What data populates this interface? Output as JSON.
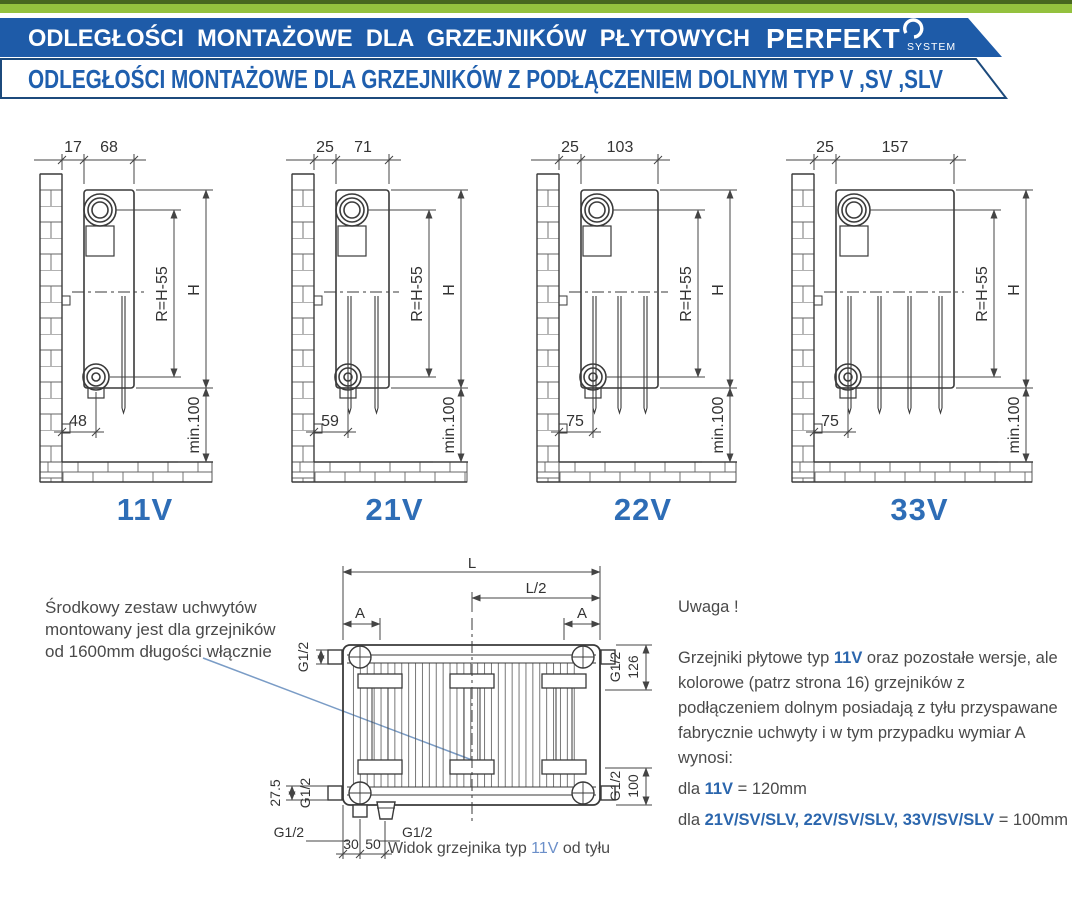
{
  "header": {
    "title": "ODLEGŁOŚCI MONTAŻOWE DLA GRZEJNIKÓW PŁYTOWYCH",
    "brand": "PERFEKT",
    "brand_sub": "SYSTEM",
    "subtitle": "ODLEGŁOŚCI MONTAŻOWE DLA GRZEJNIKÓW Z PODŁĄCZENIEM DOLNYM TYP V ,SV ,SLV",
    "colors": {
      "banner_blue": "#1e5ba8",
      "green_light": "#95c13e",
      "green_dark": "#4e6e28",
      "outline_navy": "#1c4a7c",
      "accent_blue": "#2e6db6"
    }
  },
  "diagrams": [
    {
      "label": "11V",
      "wall_offset": "17",
      "depth": "68",
      "bottom_offset": "48",
      "r_dim": "R=H-55",
      "h_dim": "H",
      "min_dim": "min.100"
    },
    {
      "label": "21V",
      "wall_offset": "25",
      "depth": "71",
      "bottom_offset": "59",
      "r_dim": "R=H-55",
      "h_dim": "H",
      "min_dim": "min.100"
    },
    {
      "label": "22V",
      "wall_offset": "25",
      "depth": "103",
      "bottom_offset": "75",
      "r_dim": "R=H-55",
      "h_dim": "H",
      "min_dim": "min.100"
    },
    {
      "label": "33V",
      "wall_offset": "25",
      "depth": "157",
      "bottom_offset": "75",
      "r_dim": "R=H-55",
      "h_dim": "H",
      "min_dim": "min.100"
    }
  ],
  "rear_view": {
    "L": "L",
    "L_half": "L/2",
    "A_left": "A",
    "A_right": "A",
    "g12_tl": "G1/2",
    "g12_tr": "G1/2",
    "d126": "126",
    "d27_5": "27.5",
    "g12_bl": "G1/2",
    "g12_br": "G1/2",
    "d100": "100",
    "d30": "30",
    "d50": "50",
    "g12_pipe_left": "G1/2",
    "g12_pipe_right": "G1/2",
    "caption_pre": "Widok grzejnika typ ",
    "caption_type": "11V",
    "caption_post": " od tyłu"
  },
  "note_left": {
    "line1": "Środkowy zestaw uchwytów",
    "line2": "montowany jest dla grzejników",
    "line3": "od 1600mm długości włącznie"
  },
  "note_right": {
    "title": "Uwaga !",
    "p1a": "Grzejniki płytowe typ ",
    "p1b": "11V",
    "p1c": " oraz pozostałe wersje, ale kolorowe (patrz strona 16) grzejników z podłączeniem dolnym posiadają z tyłu przyspawane fabrycznie uchwyty i w tym przypadku wymiar A wynosi:",
    "l2a": "dla ",
    "l2b": "11V",
    "l2c": " = 120mm",
    "l3a": "dla ",
    "l3b": "21V/SV/SLV, 22V/SV/SLV, 33V/SV/SLV",
    "l3c": " = 100mm"
  }
}
